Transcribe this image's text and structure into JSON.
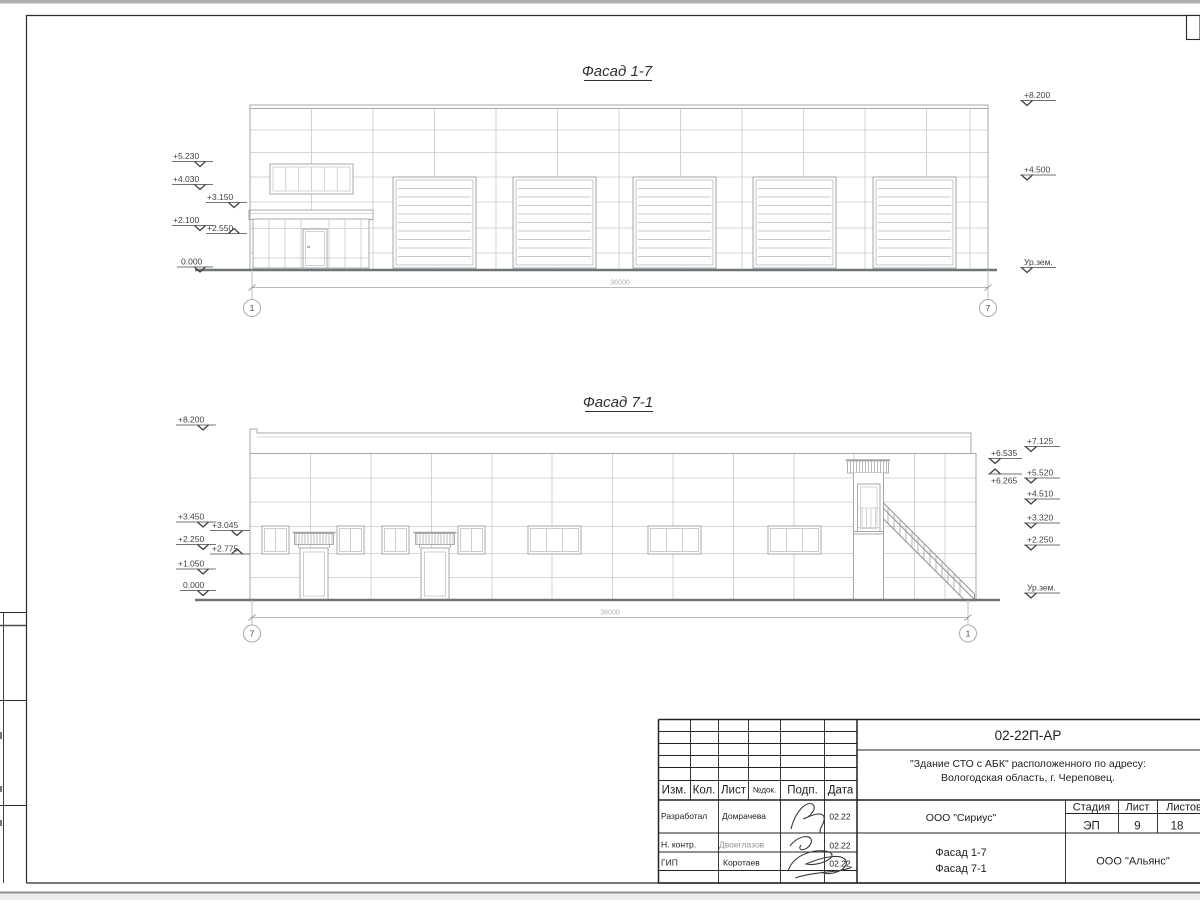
{
  "facade_top": {
    "title": "Фасад 1-7",
    "dim_total": "36000",
    "axis_left": "1",
    "axis_right": "7",
    "marks_left": [
      "+5.230",
      "+4.030",
      "+3.150",
      "+2.100",
      "+2.550",
      "0.000"
    ],
    "marks_right": [
      "+8.200",
      "+4.500",
      "Ур.зем."
    ]
  },
  "facade_bottom": {
    "title": "Фасад 7-1",
    "dim_total": "36000",
    "axis_left": "7",
    "axis_right": "1",
    "marks_left": [
      "+8.200",
      "+3.450",
      "+3.045",
      "+2.250",
      "+2.775",
      "+1.050",
      "0.000"
    ],
    "marks_right_inner": [
      "+6.535",
      "+6.265"
    ],
    "marks_right_outer": [
      "+7.125",
      "+5.520",
      "+4.510",
      "+3.320",
      "+2.250",
      "Ур.зем."
    ]
  },
  "title_block": {
    "doc_number": "02-22П-АР",
    "project_name_line1": "\"Здание СТО с АБК\" расположенного по адресу:",
    "project_name_line2": "Вологодская область, г. Череповец.",
    "col_izm": "Изм.",
    "col_kol": "Кол.",
    "col_list": "Лист",
    "col_doc": "№док.",
    "col_podp": "Подп.",
    "col_data": "Дата",
    "stage_header": "Стадия",
    "sheet_header": "Лист",
    "sheets_header": "Листов",
    "stage_value": "ЭП",
    "sheet_value": "9",
    "sheets_value": "18",
    "rows": [
      {
        "role": "Разработал",
        "name": "Домрачева",
        "date": "02.22"
      },
      {
        "role": "Н. контр.",
        "name": "Двоеглазов",
        "date": "02.22"
      },
      {
        "role": "ГИП",
        "name": "Коротаев",
        "date": "02.22"
      }
    ],
    "designer_org": "ООО \"Сириус\"",
    "sheet_title_line1": "Фасад 1-7",
    "sheet_title_line2": "Фасад 7-1",
    "customer_org": "ООО \"Альянс\""
  }
}
